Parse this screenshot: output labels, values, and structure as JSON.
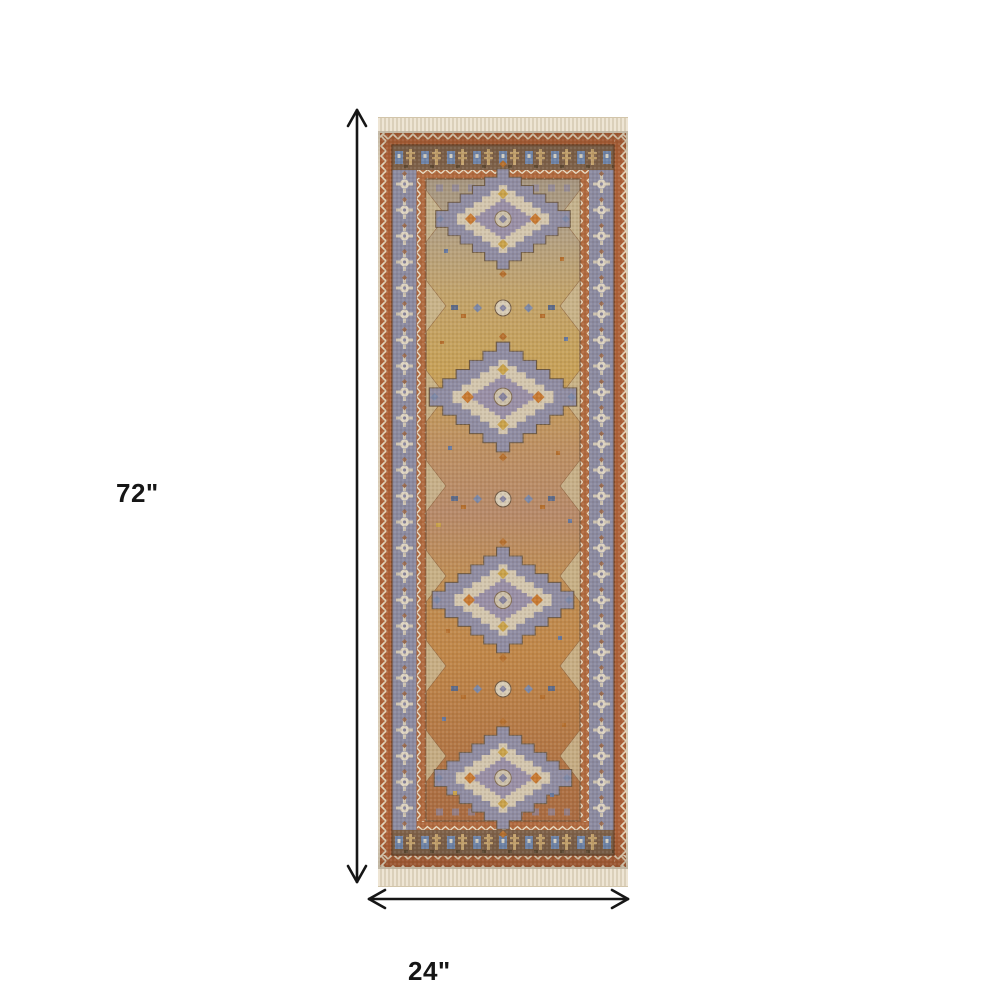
{
  "diagram": {
    "type": "product-dimension-diagram",
    "subject": "persian-style-runner-rug",
    "height_label": "72\"",
    "width_label": "24\"",
    "line_color": "#161616",
    "label_color": "#161616",
    "background": "#ffffff"
  },
  "rug": {
    "fringe_color": "#ebe2d0",
    "palette": {
      "outer_border_rust": "#ad6138",
      "border_outline_dark": "#6f4326",
      "side_border_blue_gray": "#8b8aa0",
      "top_border_brown": "#7e6149",
      "guard_zigzag_cream": "#e3d5bb",
      "field_top_gray_tan": "#a59580",
      "field_gold": "#c7a158",
      "field_rose": "#b78a6a",
      "field_orange": "#c08749",
      "field_bottom_rust": "#a96b42",
      "medallion_blue_gray": "#8f8ca2",
      "medallion_cream": "#d3c6ae",
      "accent_orange": "#c77a33",
      "accent_gold": "#c9a24a",
      "accent_blue": "#7187ac"
    }
  }
}
